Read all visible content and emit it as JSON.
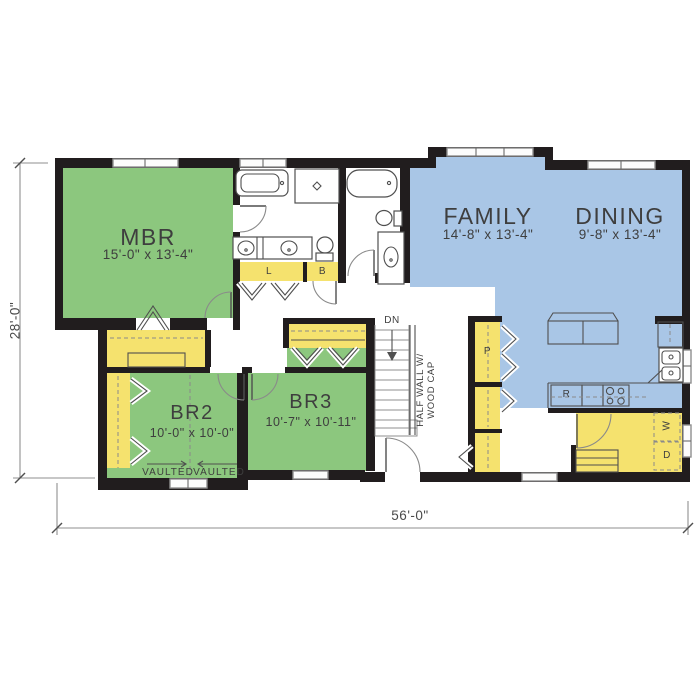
{
  "rooms": {
    "mbr": {
      "label": "MBR",
      "dims": "15'-0\" x 13'-4\""
    },
    "family": {
      "label": "FAMILY",
      "dims": "14'-8\" x 13'-4\""
    },
    "dining": {
      "label": "DINING",
      "dims": "9'-8\" x 13'-4\""
    },
    "br2": {
      "label": "BR2",
      "dims": "10'-0\" x 10'-0\""
    },
    "br3": {
      "label": "BR3",
      "dims": "10'-7\" x 10'-11\""
    }
  },
  "closets": {
    "linen": "L",
    "bath_closet": "B",
    "pantry": "P"
  },
  "appliances": {
    "refrigerator": "R",
    "washer": "W",
    "dryer": "D"
  },
  "stairs": {
    "down": "DN"
  },
  "notes": {
    "half_wall_line1": "HALF WALL W/",
    "half_wall_line2": "WOOD CAP",
    "vaulted": "VAULTED"
  },
  "dimensions": {
    "overall_width": "56'-0\"",
    "overall_depth": "28'-0\""
  },
  "colors": {
    "green": "#8cc77e",
    "blue": "#a9c6e6",
    "yellow": "#f5e26e",
    "wall": "#211d1e"
  }
}
